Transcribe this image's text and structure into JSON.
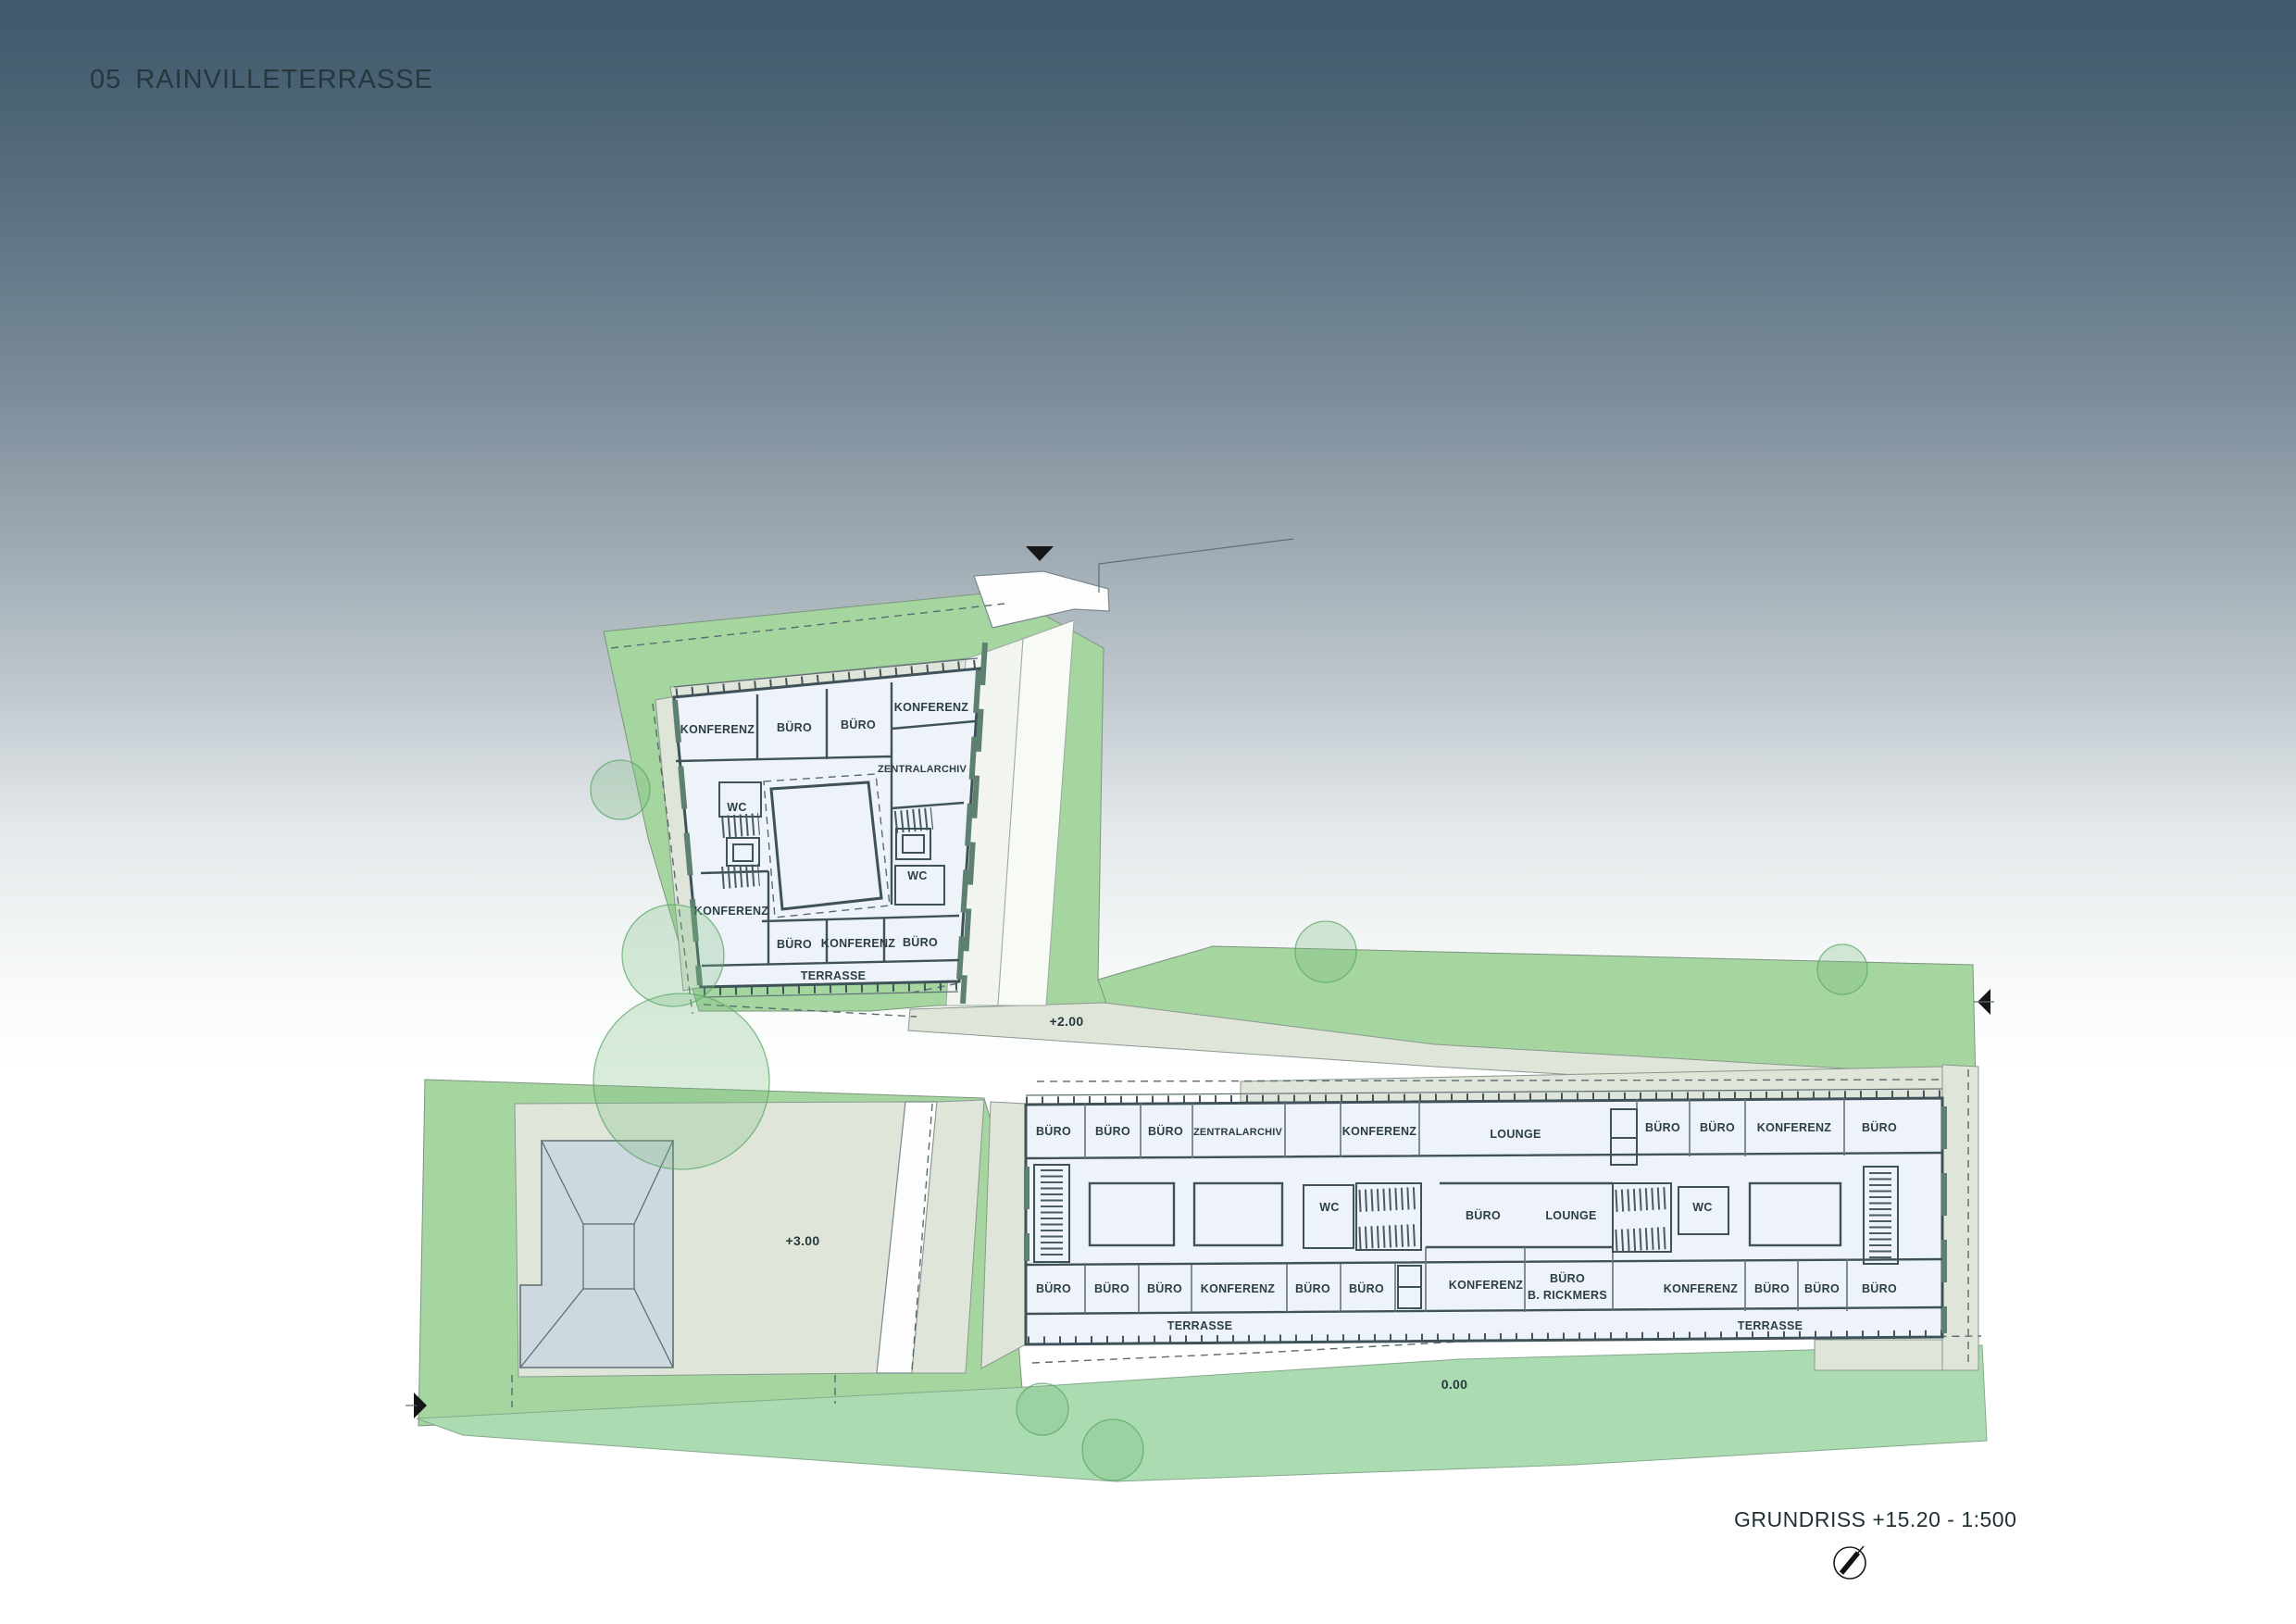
{
  "header": {
    "title": "05 RAINVILLETERRASSE"
  },
  "footer": {
    "caption": "GRUNDRISS +15.20 - 1:500",
    "north_icon": "north-arrow"
  },
  "levels": {
    "path": "+2.00",
    "yard": "+3.00",
    "ground": "0.00"
  },
  "upper_building": {
    "rooms": {
      "konferenz_nw": "KONFERENZ",
      "buero_n1": "BÜRO",
      "buero_n2": "BÜRO",
      "konferenz_ne": "KONFERENZ",
      "zentralarchiv": "ZENTRALARCHIV",
      "wc_left": "WC",
      "wc_right": "WC",
      "konferenz_w": "KONFERENZ",
      "buero_s1": "BÜRO",
      "konferenz_s": "KONFERENZ",
      "buero_s2": "BÜRO"
    },
    "terrasse": "TERRASSE"
  },
  "long_building": {
    "top_row": [
      "BÜRO",
      "BÜRO",
      "BÜRO",
      "ZENTRALARCHIV",
      "KONFERENZ",
      "LOUNGE",
      "BÜRO",
      "BÜRO",
      "KONFERENZ",
      "BÜRO"
    ],
    "middle_row": [
      "WC",
      "BÜRO",
      "LOUNGE",
      "WC"
    ],
    "bottom_row": [
      "BÜRO",
      "BÜRO",
      "BÜRO",
      "KONFERENZ",
      "BÜRO",
      "BÜRO",
      "KONFERENZ",
      "KONFERENZ",
      "BÜRO",
      "BÜRO",
      "BÜRO"
    ],
    "rickmers": [
      "BÜRO",
      "B. RICKMERS"
    ],
    "terrasse_left": "TERRASSE",
    "terrasse_right": "TERRASSE"
  },
  "colors": {
    "background_top": "#3f5a6d",
    "park_green": "#a6d6a0",
    "lawn_mint": "#abdcb1",
    "path_sage": "#dfe6d9",
    "room_fill": "#edf3f8",
    "wall": "#3f5259",
    "accent_teal": "#5d8070",
    "roof_fill": "#cdd9de",
    "label_text": "#2c3e45"
  }
}
